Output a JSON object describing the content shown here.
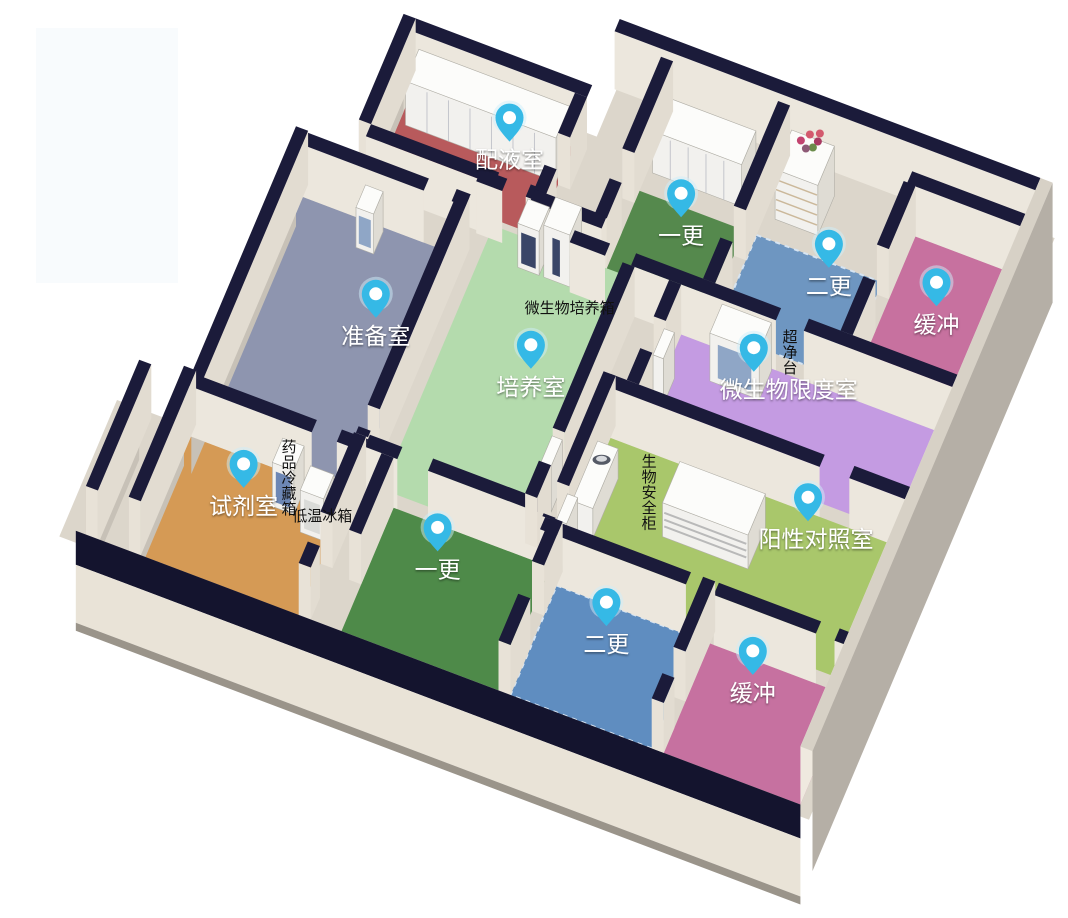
{
  "scene": {
    "background": "#ffffff",
    "pin_color": "#35b9e6",
    "pin_inner_color": "#ffffff",
    "wall_top_color": "#1b1b3a",
    "wall_face_color": "#ece7dd",
    "slab_color": "#dcd6cb"
  },
  "rooms": [
    {
      "id": "peiyeshi",
      "label": "配液室",
      "floor_color": "#b85a5c"
    },
    {
      "id": "yigeng_top",
      "label": "一更",
      "floor_color": "#55894d"
    },
    {
      "id": "ergeng_top",
      "label": "二更",
      "floor_color": "#6e96c1"
    },
    {
      "id": "huanchong_top",
      "label": "缓冲",
      "floor_color": "#c7719f"
    },
    {
      "id": "zhunbeishi",
      "label": "准备室",
      "floor_color": "#8e95af"
    },
    {
      "id": "peiyangshi",
      "label": "培养室",
      "floor_color": "#b4dbad"
    },
    {
      "id": "weishengwu_xiandushi",
      "label": "微生物限度室",
      "floor_color": "#c49be2"
    },
    {
      "id": "shijishi",
      "label": "试剂室",
      "floor_color": "#d59a55"
    },
    {
      "id": "yigeng_bottom",
      "label": "一更",
      "floor_color": "#4e8a49"
    },
    {
      "id": "ergeng_bottom",
      "label": "二更",
      "floor_color": "#5f8dc0"
    },
    {
      "id": "yangxing_duizhaoshi",
      "label": "阳性对照室",
      "floor_color": "#a9c76b"
    },
    {
      "id": "huanchong_bottom",
      "label": "缓冲",
      "floor_color": "#c671a0"
    }
  ],
  "equipment_labels": [
    {
      "id": "incubator",
      "label": "微生物培养箱",
      "orientation": "horizontal"
    },
    {
      "id": "clean_bench",
      "label": "超净台",
      "orientation": "vertical"
    },
    {
      "id": "medicine_fridge",
      "label": "药品冷藏箱",
      "orientation": "vertical"
    },
    {
      "id": "low_temp_freezer",
      "label": "低温冰箱",
      "orientation": "horizontal"
    },
    {
      "id": "biosafety_cabinet",
      "label": "生物安全柜",
      "orientation": "vertical"
    }
  ]
}
